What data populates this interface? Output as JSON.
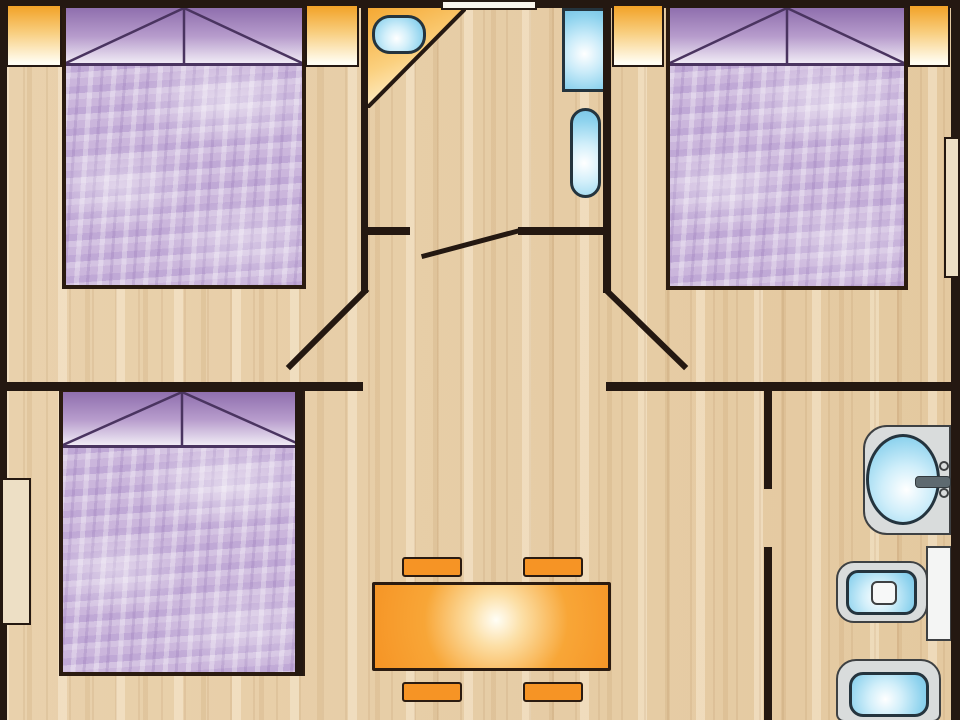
{
  "document": {
    "type": "floor-plan",
    "subject": "Mobile-home / holiday cabin, 3 bedrooms, top-down view",
    "visible_text": "none",
    "canvas": {
      "width": 960,
      "height": 720
    }
  },
  "palette": {
    "wall": "#241811",
    "floor_base": "#E7CEA8",
    "window_orange": "#F2A227",
    "purple_dark": "#8F6FAE",
    "purple_light": "#F0EBF5",
    "pillow_line": "#4A3460",
    "mattress": "#CBB6DC",
    "fixture_blue": "#7CC6E6",
    "fixture_outline": "#24343E",
    "fixture_gray": "#D9DCDC",
    "gray_outline": "#3E4143",
    "accent_orange": "#F69425",
    "door_leaf_fill": "#F8F4EC",
    "side_window_fill": "#EDDFC5"
  },
  "rooms": [
    {
      "name": "bedroom-top-left",
      "contents": [
        "double-bed"
      ],
      "windows": 2,
      "door": "open-leaf-to-hallway"
    },
    {
      "name": "bathroom-top-middle",
      "contents": [
        "corner-washbasin",
        "shower",
        "toilet"
      ],
      "doors": [
        "entry-door-top-wall",
        "door-to-hallway"
      ]
    },
    {
      "name": "bedroom-top-right",
      "contents": [
        "double-bed"
      ],
      "windows": 3,
      "door": "open-leaf-to-hallway"
    },
    {
      "name": "bedroom-bottom-left",
      "contents": [
        "double-bed"
      ],
      "windows": 1,
      "door": "opening-bottom-right"
    },
    {
      "name": "living-dining-area",
      "contents": [
        "dining-table",
        "chair",
        "chair",
        "chair",
        "chair"
      ]
    },
    {
      "name": "bathroom-bottom-right",
      "contents": [
        "washbasin-counter",
        "toilet-with-tank",
        "bidet"
      ],
      "door": "gap-in-left-wall"
    }
  ],
  "furniture": [
    {
      "id": "bed-1",
      "type": "double-bed",
      "room": "bedroom-top-left",
      "rect": [
        62,
        4,
        244,
        285
      ]
    },
    {
      "id": "bed-2",
      "type": "double-bed",
      "room": "bedroom-top-right",
      "rect": [
        666,
        4,
        242,
        286
      ]
    },
    {
      "id": "bed-3",
      "type": "double-bed",
      "room": "bedroom-bottom-left",
      "rect": [
        59,
        388,
        246,
        288
      ]
    },
    {
      "id": "corner-counter",
      "type": "triangular-corner-counter",
      "room": "bathroom-top-middle",
      "triangle": [
        [
          367,
          8
        ],
        [
          466,
          8
        ],
        [
          367,
          107
        ]
      ]
    },
    {
      "id": "wc-basin",
      "type": "washbasin",
      "room": "bathroom-top-middle",
      "rect": [
        372,
        15,
        54,
        39
      ]
    },
    {
      "id": "shower",
      "type": "shower",
      "room": "bathroom-top-middle",
      "rect": [
        562,
        8,
        45,
        84
      ]
    },
    {
      "id": "wc-toilet",
      "type": "toilet",
      "room": "bathroom-top-middle",
      "rect": [
        570,
        108,
        31,
        90
      ]
    },
    {
      "id": "bath-counter",
      "type": "washbasin-counter",
      "room": "bathroom-bottom-right",
      "rect": [
        863,
        425,
        88,
        110
      ]
    },
    {
      "id": "bath-basin",
      "type": "washbasin-bowl",
      "room": "bathroom-bottom-right",
      "rect": [
        866,
        434,
        74,
        91
      ]
    },
    {
      "id": "bath-faucet",
      "type": "faucet",
      "room": "bathroom-bottom-right",
      "rect": [
        915,
        476,
        34,
        10
      ]
    },
    {
      "id": "toilet-tank",
      "type": "toilet-cistern",
      "room": "bathroom-bottom-right",
      "rect": [
        926,
        546,
        26,
        95
      ]
    },
    {
      "id": "toilet-bowl",
      "type": "toilet-bowl",
      "room": "bathroom-bottom-right",
      "rect": [
        836,
        561,
        92,
        62
      ]
    },
    {
      "id": "bidet",
      "type": "bidet",
      "room": "bathroom-bottom-right",
      "rect": [
        836,
        659,
        105,
        62
      ]
    },
    {
      "id": "dining-table",
      "type": "dining-table",
      "room": "living-dining-area",
      "rect": [
        372,
        582,
        239,
        89
      ]
    },
    {
      "id": "chair-1",
      "type": "chair",
      "room": "living-dining-area",
      "rect": [
        402,
        557,
        60,
        20
      ]
    },
    {
      "id": "chair-2",
      "type": "chair",
      "room": "living-dining-area",
      "rect": [
        523,
        557,
        60,
        20
      ]
    },
    {
      "id": "chair-3",
      "type": "chair",
      "room": "living-dining-area",
      "rect": [
        402,
        682,
        60,
        20
      ]
    },
    {
      "id": "chair-4",
      "type": "chair",
      "room": "living-dining-area",
      "rect": [
        523,
        682,
        60,
        20
      ]
    }
  ],
  "openings": {
    "entry_door": {
      "type": "exterior-door",
      "rect": [
        441,
        0,
        96,
        10
      ],
      "wall_gap_x": [
        441,
        537
      ]
    },
    "door_leaves": [
      {
        "id": "bedroom-top-left-door",
        "line": [
          365,
          291,
          290,
          366
        ]
      },
      {
        "id": "bedroom-top-right-door",
        "line": [
          607,
          291,
          684,
          366
        ]
      },
      {
        "id": "bathroom-top-door",
        "line": [
          424,
          256,
          518,
          231
        ]
      }
    ],
    "windows_orange": [
      [
        6,
        4,
        56,
        63
      ],
      [
        305,
        4,
        54,
        63
      ],
      [
        612,
        4,
        52,
        63
      ],
      [
        908,
        4,
        42,
        63
      ]
    ],
    "window_right_wall": [
      944,
      137,
      16,
      141
    ],
    "window_left_wall": [
      1,
      478,
      30,
      147
    ]
  },
  "walls": [
    [
      0,
      0,
      441,
      8
    ],
    [
      537,
      0,
      423,
      8
    ],
    [
      0,
      0,
      7,
      720
    ],
    [
      951,
      0,
      9,
      720
    ],
    [
      361,
      0,
      7,
      293
    ],
    [
      603,
      0,
      8,
      293
    ],
    [
      361,
      227,
      49,
      8
    ],
    [
      518,
      227,
      93,
      8
    ],
    [
      0,
      382,
      363,
      9
    ],
    [
      606,
      382,
      354,
      9
    ],
    [
      295,
      391,
      8,
      285
    ],
    [
      764,
      391,
      8,
      98
    ],
    [
      764,
      547,
      8,
      173
    ]
  ]
}
